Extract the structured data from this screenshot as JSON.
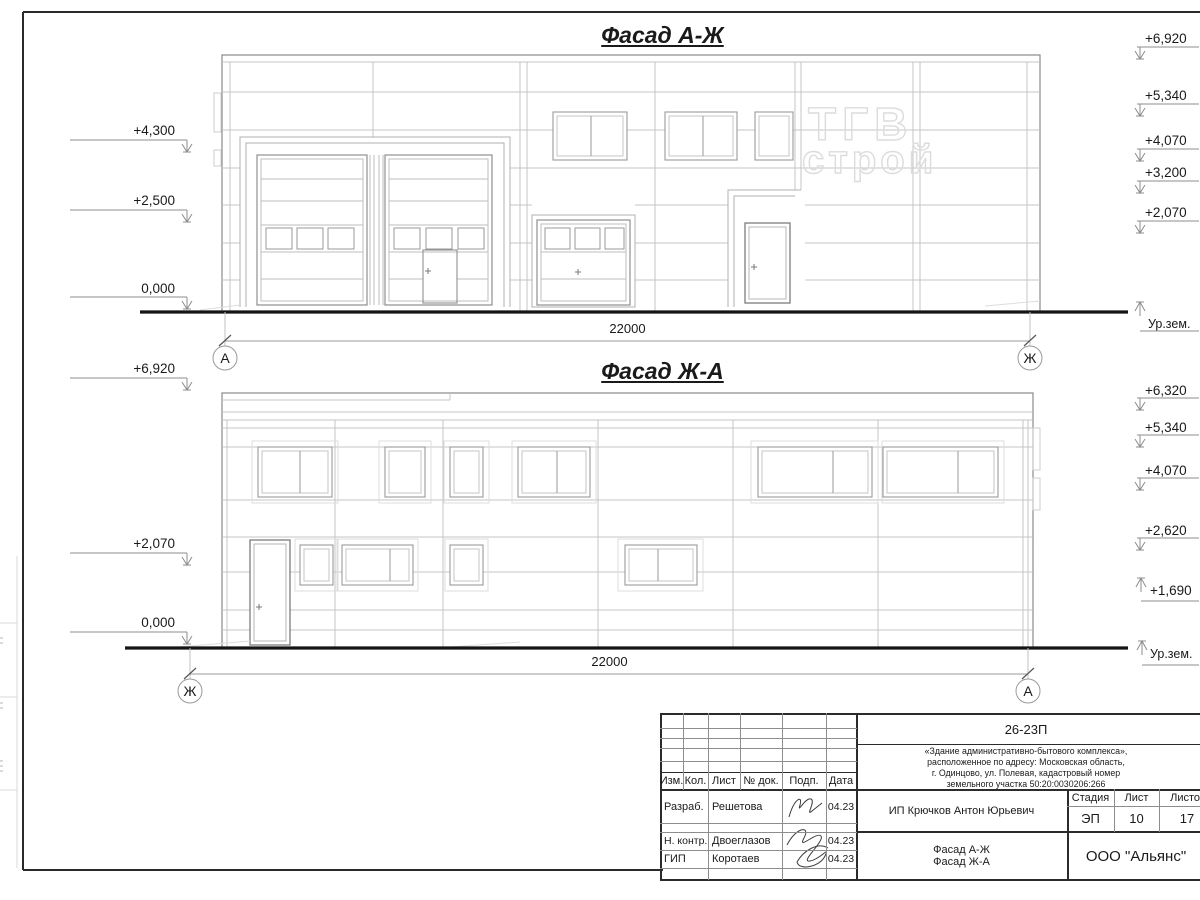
{
  "facade1": {
    "title": "Фасад А-Ж",
    "dimension": "22000",
    "axis_left": "А",
    "axis_right": "Ж",
    "ground_label": "Ур.зем.",
    "watermark": {
      "line1": "ТГВ",
      "line2": "строй"
    },
    "marks_left": [
      {
        "label": "+4,300"
      },
      {
        "label": "+2,500"
      },
      {
        "label": "0,000"
      }
    ],
    "marks_right": [
      {
        "label": "+6,920"
      },
      {
        "label": "+5,340"
      },
      {
        "label": "+4,070"
      },
      {
        "label": "+3,200"
      },
      {
        "label": "+2,070"
      }
    ]
  },
  "facade2": {
    "title": "Фасад Ж-А",
    "dimension": "22000",
    "axis_left": "Ж",
    "axis_right": "А",
    "ground_label": "Ур.зем.",
    "marks_left": [
      {
        "label": "+6,920"
      },
      {
        "label": "+2,070"
      },
      {
        "label": "0,000"
      }
    ],
    "marks_right": [
      {
        "label": "+6,320"
      },
      {
        "label": "+5,340"
      },
      {
        "label": "+4,070"
      },
      {
        "label": "+2,620"
      },
      {
        "label": "+1,690"
      }
    ]
  },
  "title_block": {
    "code": "26-23П",
    "project_description": [
      "«Здание административно-бытового комплекса»,",
      "расположенное по адресу: Московская область,",
      "г. Одинцово, ул. Полевая, кадастровый номер",
      "земельного участка 50:20:0030206:266"
    ],
    "columns": {
      "izm": "Изм.",
      "kol": "Кол.",
      "list": "Лист",
      "doc": "№ док.",
      "podp": "Подп.",
      "data": "Дата"
    },
    "rows": [
      {
        "role": "Разраб.",
        "name": "Решетова",
        "date": "04.23"
      },
      {
        "role": "Н. контр.",
        "name": "Двоеглазов",
        "date": "04.23"
      },
      {
        "role": "ГИП",
        "name": "Коротаев",
        "date": "04.23"
      }
    ],
    "client": "ИП Крючков Антон Юрьевич",
    "stage_header": {
      "stage": "Стадия",
      "sheet": "Лист",
      "sheets": "Листов"
    },
    "stage_values": {
      "stage": "ЭП",
      "sheet": "10",
      "sheets": "17"
    },
    "sheet_title": {
      "line1": "Фасад А-Ж",
      "line2": "Фасад Ж-А"
    },
    "company": "ООО \"Альянс\""
  }
}
